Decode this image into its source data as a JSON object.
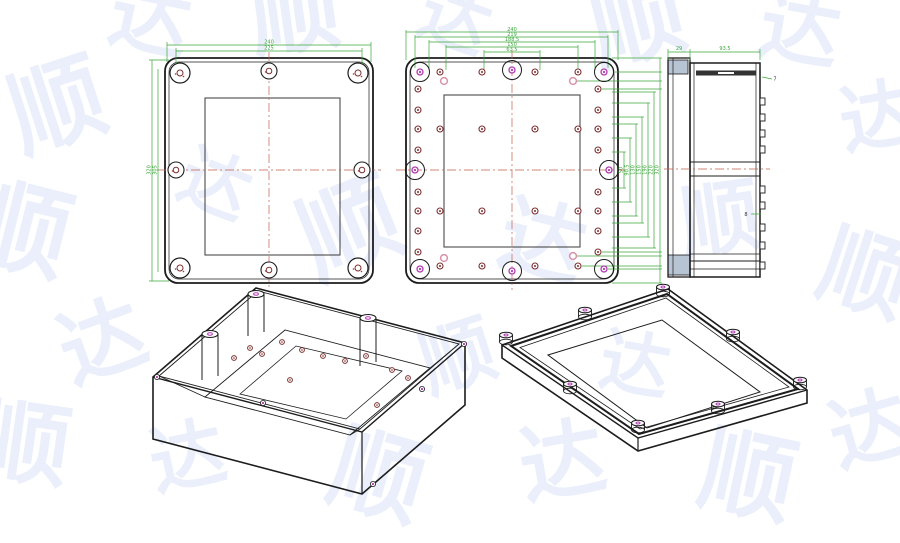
{
  "watermark": {
    "chars": [
      "顺",
      "达"
    ],
    "color": "#eaeffb"
  },
  "colors": {
    "outline": "#1c1c1c",
    "dim_green": "#3aa63a",
    "centerline_red": "#c4604c",
    "hole_dark": "#7c2f2f",
    "hole_pink": "#d893a8",
    "hole_magenta": "#b13ab1",
    "panel_gray": "#b7c4d4",
    "inner_line": "#4a4a4a"
  },
  "views": {
    "lid_top": {
      "dims_top": [
        "240",
        "225"
      ],
      "dims_left": [
        "320",
        "305"
      ]
    },
    "base_top": {
      "dims_top": [
        "240",
        "219",
        "188.5",
        "150",
        "63.5"
      ],
      "dims_right": [
        "50",
        "90.5",
        "130",
        "150",
        "190",
        "220",
        "320"
      ],
      "holes": {
        "dark": [
          [
            34,
            14
          ],
          [
            76,
            14
          ],
          [
            129,
            14
          ],
          [
            172,
            14
          ],
          [
            12,
            31
          ],
          [
            192,
            31
          ],
          [
            12,
            52
          ],
          [
            192,
            52
          ],
          [
            12,
            71
          ],
          [
            192,
            71
          ],
          [
            12,
            92
          ],
          [
            192,
            92
          ],
          [
            12,
            134
          ],
          [
            192,
            134
          ],
          [
            12,
            153
          ],
          [
            192,
            153
          ],
          [
            12,
            173
          ],
          [
            192,
            173
          ],
          [
            12,
            194
          ],
          [
            192,
            194
          ],
          [
            34,
            71
          ],
          [
            76,
            71
          ],
          [
            129,
            71
          ],
          [
            172,
            71
          ],
          [
            34,
            153
          ],
          [
            76,
            153
          ],
          [
            129,
            153
          ],
          [
            172,
            153
          ],
          [
            34,
            208
          ],
          [
            76,
            208
          ],
          [
            129,
            208
          ],
          [
            172,
            208
          ]
        ],
        "pink": [
          [
            38,
            23
          ],
          [
            167,
            23
          ],
          [
            38,
            200
          ],
          [
            167,
            198
          ]
        ],
        "magenta": [
          [
            14,
            14
          ],
          [
            198,
            14
          ],
          [
            14,
            211
          ],
          [
            198,
            211
          ],
          [
            106,
            12
          ],
          [
            106,
            213
          ],
          [
            9,
            112
          ],
          [
            203,
            112
          ]
        ]
      }
    },
    "side": {
      "dims": {
        "flange": "29",
        "depth": "93.5",
        "lip": "7",
        "rib": "8"
      }
    },
    "iso_base": {
      "floor_holes": [
        [
          250,
          348
        ],
        [
          282,
          342
        ],
        [
          302,
          350
        ],
        [
          323,
          356
        ],
        [
          345,
          361
        ],
        [
          366,
          356
        ],
        [
          392,
          370
        ],
        [
          408,
          378
        ],
        [
          290,
          380
        ],
        [
          377,
          405
        ],
        [
          262,
          354
        ],
        [
          234,
          358
        ]
      ]
    },
    "iso_lid": {}
  }
}
